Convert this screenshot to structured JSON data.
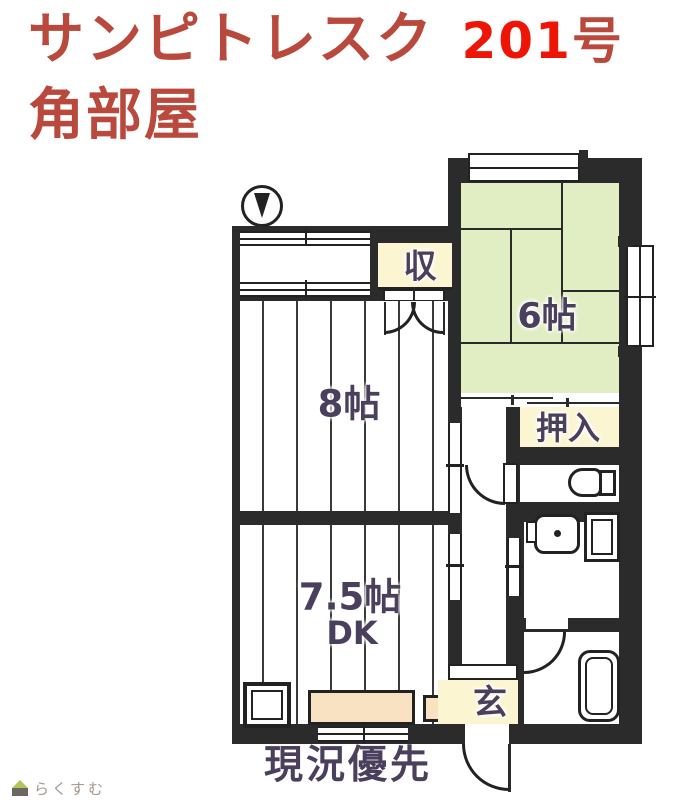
{
  "title": {
    "building_name": "サンピトレスク",
    "unit_number": "201",
    "unit_suffix": "号",
    "subtitle": "角部屋"
  },
  "plan": {
    "rooms": {
      "living8": {
        "label": "8帖"
      },
      "dk": {
        "size": "7.5帖",
        "type": "DK"
      },
      "tatami6": {
        "label": "6帖"
      },
      "storage": {
        "label": "収"
      },
      "oshiire": {
        "label": "押入"
      },
      "genkan": {
        "label": "玄"
      }
    },
    "note": "現況優先",
    "icons": {
      "compass-icon": "circle with downward north arrow",
      "toilet-icon": "toilet bowl with tank",
      "sink-icon": "round wash basin",
      "washer-icon": "washing machine pan square",
      "bathtub-icon": "bathtub rounded rectangle",
      "house-icon": "rakusumu logo house"
    },
    "colors": {
      "tatami_green": "#e1eec3",
      "closet_yellow": "#fbf5d2",
      "counter_peach": "#f9e2c2",
      "wall_black": "#2b2b2b",
      "title_red": "#b8493c",
      "unit_red": "#ee1506",
      "label_purple": "#4a3f5c"
    }
  },
  "watermark": {
    "brand": "らくすむ"
  }
}
